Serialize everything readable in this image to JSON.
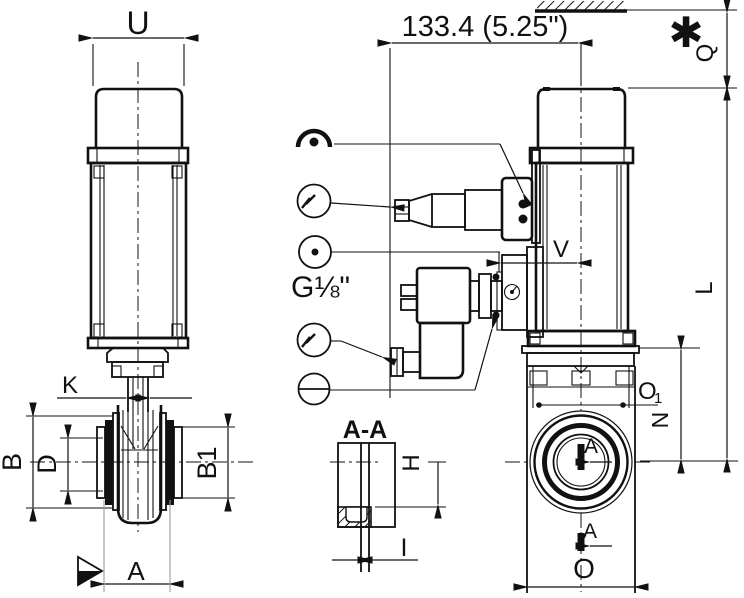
{
  "drawing": {
    "type": "technical-dimension-drawing",
    "views": {
      "front_view": "actuated valve - front elevation",
      "side_view": "actuated valve - side elevation with solenoid pilot",
      "section": "A-A stem slot detail"
    },
    "labels": {
      "u": "U",
      "k": "K",
      "b": "B",
      "d": "D",
      "b1": "B1",
      "a": "A",
      "overall_width": "133.4 (5.25\")",
      "q": "Q",
      "l": "L",
      "n": "N",
      "v": "V",
      "o": "O",
      "o1_main": "O",
      "o1_sub": "1",
      "section_name": "A-A",
      "h": "H",
      "i": "I",
      "air_port": "G⅛\"",
      "footnote_marker": "✱",
      "section_arrow_top": "A",
      "section_arrow_bottom": "A"
    },
    "callouts": [
      {
        "symbol": "position-indicator"
      },
      {
        "symbol": "electrical-connection-top"
      },
      {
        "symbol": "air-connection",
        "thread": "G⅛\""
      },
      {
        "symbol": "electrical-connection-solenoid"
      },
      {
        "symbol": "manual-override"
      }
    ],
    "colors": {
      "line": "#111111",
      "background": "#ffffff",
      "extension_gray": "#9a9a9a"
    }
  }
}
